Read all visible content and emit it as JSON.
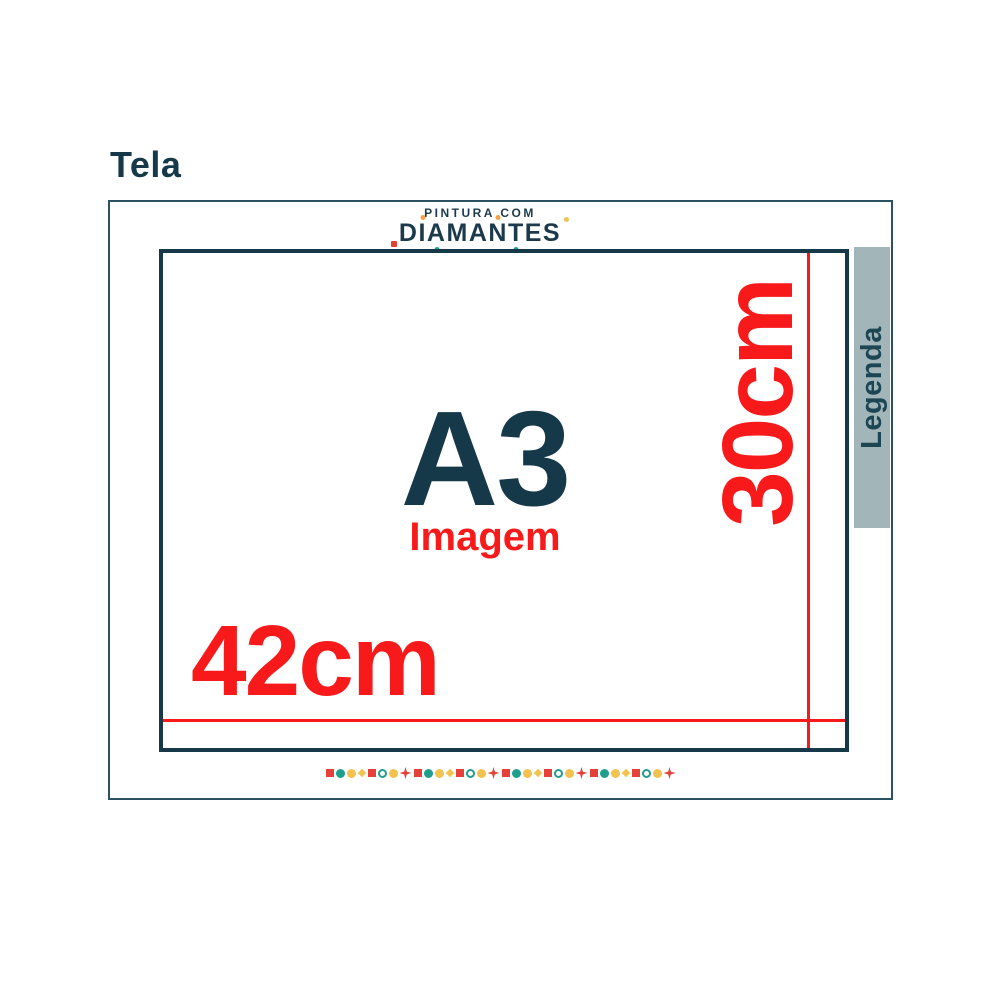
{
  "page": {
    "title": "Tela"
  },
  "logo": {
    "line1": "PINTURA COM",
    "line2": "DIAMANTES",
    "dots": [
      {
        "index": 0,
        "pos": "bottom-left",
        "color": "red",
        "shape": "square"
      },
      {
        "index": 1,
        "pos": "top",
        "color": "orange",
        "shape": "circle"
      },
      {
        "index": 2,
        "pos": "bottom",
        "color": "teal",
        "shape": "circle"
      },
      {
        "index": 5,
        "pos": "top",
        "color": "orange",
        "shape": "circle"
      },
      {
        "index": 6,
        "pos": "bottom",
        "color": "teal",
        "shape": "circle"
      },
      {
        "index": 8,
        "pos": "top-right",
        "color": "yellow",
        "shape": "circle"
      }
    ]
  },
  "canvas": {
    "size_label": "A3",
    "image_label": "Imagem",
    "width_label": "42cm",
    "height_label": "30cm"
  },
  "legend": {
    "label": "Legenda"
  },
  "decor_row": {
    "repeat": 4,
    "pattern": [
      "square-red",
      "circle-teal",
      "circle-yellow",
      "diamond-yellow",
      "square-red",
      "ring-teal",
      "circle-yellow",
      "star-red"
    ]
  },
  "colors": {
    "dark_teal": "#16394A",
    "navy": "#1D3A4C",
    "red": "#F8191B",
    "legend_bar": "#A2B5B9",
    "legend_text": "#1D4655",
    "frame_border": "#2B5260",
    "dot_red": "#E5403A",
    "dot_teal": "#1F9E8E",
    "dot_yellow": "#F2C14E",
    "dot_orange": "#F5A04A"
  }
}
